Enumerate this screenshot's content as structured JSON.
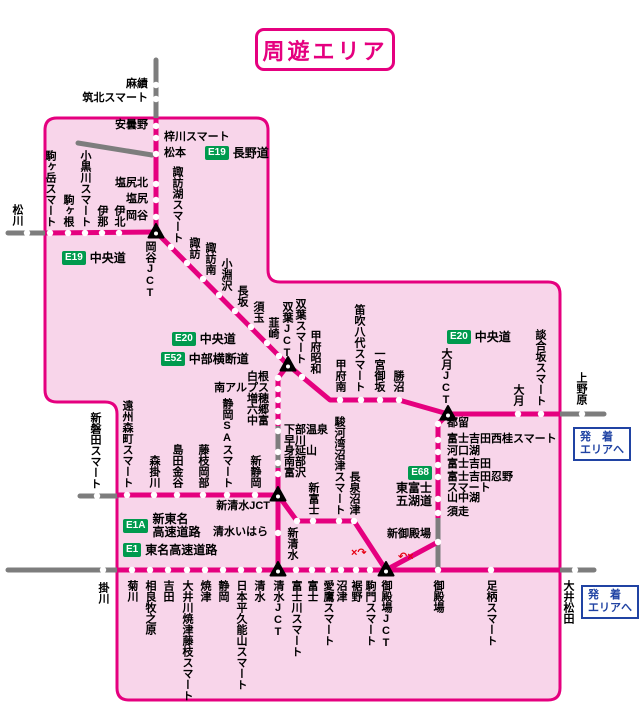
{
  "title": "周遊エリア",
  "colors": {
    "pink": "#e5007f",
    "area_fill": "#f8d5ea",
    "gray": "#7d7d7d",
    "green": "#009a4e",
    "blue": "#2043a3",
    "red": "#e60012"
  },
  "roads": [
    {
      "code": "E19",
      "lines": [
        "長野道"
      ],
      "x": 205,
      "y": 146,
      "dir": "row"
    },
    {
      "code": "E19",
      "lines": [
        "中央道"
      ],
      "x": 62,
      "y": 251,
      "dir": "row"
    },
    {
      "code": "E20",
      "lines": [
        "中央道"
      ],
      "x": 172,
      "y": 332,
      "dir": "row"
    },
    {
      "code": "E52",
      "lines": [
        "中部横断道"
      ],
      "x": 161,
      "y": 352,
      "dir": "row"
    },
    {
      "code": "E20",
      "lines": [
        "中央道"
      ],
      "x": 447,
      "y": 330,
      "dir": "row"
    },
    {
      "code": "E68",
      "lines": [
        "東富士",
        "五湖道"
      ],
      "x": 432,
      "y": 466,
      "dir": "col",
      "align": "right"
    },
    {
      "code": "E1A",
      "lines": [
        "新東名",
        "高速道路"
      ],
      "x": 123,
      "y": 513,
      "dir": "row"
    },
    {
      "code": "E1",
      "lines": [
        "東名高速道路"
      ],
      "x": 123,
      "y": 543,
      "dir": "row"
    }
  ],
  "legend_boxes": [
    {
      "lines": [
        "発　着",
        "エリアへ"
      ],
      "x": 573,
      "y": 427
    },
    {
      "lines": [
        "発　着",
        "エリアへ"
      ],
      "x": 581,
      "y": 585
    }
  ],
  "red_marks": [
    {
      "text": "×↷",
      "x": 351,
      "y": 548
    },
    {
      "text": "↶×",
      "x": 398,
      "y": 552
    }
  ],
  "stations": [
    {
      "t": "麻績",
      "x": 148,
      "y": 85,
      "o": "hl"
    },
    {
      "t": "筑北スマート",
      "x": 148,
      "y": 99,
      "o": "hl"
    },
    {
      "t": "安曇野",
      "x": 148,
      "y": 126,
      "o": "hl"
    },
    {
      "t": "梓川スマート",
      "x": 164,
      "y": 138,
      "o": "hr"
    },
    {
      "t": "松本",
      "x": 164,
      "y": 154,
      "o": "hr"
    },
    {
      "t": "塩尻北",
      "x": 148,
      "y": 184,
      "o": "hl"
    },
    {
      "t": "塩尻",
      "x": 148,
      "y": 200,
      "o": "hl"
    },
    {
      "t": "岡谷",
      "x": 148,
      "y": 217,
      "o": "hl"
    },
    {
      "t": "松川",
      "x": 17,
      "y": 226,
      "o": "vu"
    },
    {
      "t": "駒ヶ岳スマート",
      "x": 50,
      "y": 227,
      "o": "vu"
    },
    {
      "t": "駒ヶ根",
      "x": 68,
      "y": 227,
      "o": "vu"
    },
    {
      "t": "小黒川スマート",
      "x": 85,
      "y": 227,
      "o": "vu"
    },
    {
      "t": "伊那",
      "x": 102,
      "y": 227,
      "o": "vu"
    },
    {
      "t": "伊北",
      "x": 119,
      "y": 227,
      "o": "vu"
    },
    {
      "t": "岡谷JCT",
      "x": 150,
      "y": 241,
      "o": "vd"
    },
    {
      "t": "諏訪湖スマート",
      "x": 177,
      "y": 243,
      "o": "vu"
    },
    {
      "t": "諏訪",
      "x": 194,
      "y": 259,
      "o": "vu"
    },
    {
      "t": "諏訪南",
      "x": 210,
      "y": 275,
      "o": "vu"
    },
    {
      "t": "小淵沢",
      "x": 226,
      "y": 291,
      "o": "vu"
    },
    {
      "t": "長坂",
      "x": 242,
      "y": 307,
      "o": "vu"
    },
    {
      "t": "須玉",
      "x": 258,
      "y": 323,
      "o": "vu"
    },
    {
      "t": "韮崎",
      "x": 273,
      "y": 339,
      "o": "vu"
    },
    {
      "t": "双葉JCT",
      "x": 287,
      "y": 359,
      "o": "vu"
    },
    {
      "t": "双葉スマート",
      "x": 300,
      "y": 364,
      "o": "vu"
    },
    {
      "t": "甲府昭和",
      "x": 315,
      "y": 374,
      "o": "vu"
    },
    {
      "t": "甲府南",
      "x": 340,
      "y": 392,
      "o": "vu"
    },
    {
      "t": "笛吹八代スマート",
      "x": 359,
      "y": 392,
      "o": "vu"
    },
    {
      "t": "一宮御坂",
      "x": 379,
      "y": 392,
      "o": "vu"
    },
    {
      "t": "勝沼",
      "x": 398,
      "y": 392,
      "o": "vu"
    },
    {
      "t": "大月JCT",
      "x": 446,
      "y": 406,
      "o": "vu"
    },
    {
      "t": "大月",
      "x": 518,
      "y": 406,
      "o": "vu"
    },
    {
      "t": "談合坂スマート",
      "x": 540,
      "y": 406,
      "o": "vu"
    },
    {
      "t": "上野原",
      "x": 581,
      "y": 405,
      "o": "vu"
    },
    {
      "t": "都留",
      "x": 447,
      "y": 424,
      "o": "hr"
    },
    {
      "t": "富士吉田西桂スマート",
      "x": 447,
      "y": 440,
      "o": "hr"
    },
    {
      "t": "河口湖",
      "x": 447,
      "y": 452,
      "o": "hr"
    },
    {
      "t": "富士吉田",
      "x": 447,
      "y": 465,
      "o": "hr"
    },
    {
      "t": "富士吉田忍野スマート",
      "lines": [
        "富士吉田忍野",
        "スマート"
      ],
      "x": 447,
      "y": 472,
      "o": "hr"
    },
    {
      "t": "山中湖",
      "x": 447,
      "y": 499,
      "o": "hr"
    },
    {
      "t": "須走",
      "x": 447,
      "y": 513,
      "o": "hr"
    },
    {
      "t": "新御殿場",
      "x": 431,
      "y": 535,
      "o": "hl"
    },
    {
      "t": "白根",
      "x": 269,
      "y": 378,
      "o": "hl"
    },
    {
      "t": "南アルプス",
      "x": 269,
      "y": 389,
      "o": "hl"
    },
    {
      "t": "増穂",
      "x": 269,
      "y": 400,
      "o": "hl"
    },
    {
      "t": "六郷",
      "x": 269,
      "y": 411,
      "o": "hl"
    },
    {
      "t": "中富",
      "x": 269,
      "y": 422,
      "o": "hl"
    },
    {
      "t": "下部温泉早川",
      "lines": [
        "下部温泉",
        "早川"
      ],
      "x": 284,
      "y": 425,
      "o": "hr"
    },
    {
      "t": "身延山",
      "x": 284,
      "y": 452,
      "o": "hr"
    },
    {
      "t": "南部",
      "x": 284,
      "y": 463,
      "o": "hr"
    },
    {
      "t": "富沢",
      "x": 284,
      "y": 474,
      "o": "hr"
    },
    {
      "t": "新磐田スマート",
      "x": 95,
      "y": 489,
      "o": "vu"
    },
    {
      "t": "遠州森町スマート",
      "x": 127,
      "y": 488,
      "o": "vu"
    },
    {
      "t": "森掛川",
      "x": 154,
      "y": 488,
      "o": "vu"
    },
    {
      "t": "島田金谷",
      "x": 177,
      "y": 488,
      "o": "vu"
    },
    {
      "t": "藤枝岡部",
      "x": 203,
      "y": 488,
      "o": "vu"
    },
    {
      "t": "静岡SAスマート",
      "x": 227,
      "y": 488,
      "o": "vu"
    },
    {
      "t": "新静岡",
      "x": 255,
      "y": 488,
      "o": "vu"
    },
    {
      "t": "新清水JCT",
      "x": 270,
      "y": 507,
      "o": "hl"
    },
    {
      "t": "清水いはら",
      "x": 268,
      "y": 533,
      "o": "hl"
    },
    {
      "t": "新清水",
      "x": 292,
      "y": 527,
      "o": "vd"
    },
    {
      "t": "新富士",
      "x": 313,
      "y": 515,
      "o": "vu"
    },
    {
      "t": "駿河湾沼津スマート",
      "x": 339,
      "y": 515,
      "o": "vu"
    },
    {
      "t": "長泉沼津",
      "x": 354,
      "y": 515,
      "o": "vu"
    },
    {
      "t": "掛川",
      "x": 103,
      "y": 582,
      "o": "vd"
    },
    {
      "t": "菊川",
      "x": 132,
      "y": 580,
      "o": "vd"
    },
    {
      "t": "相良牧之原",
      "x": 150,
      "y": 580,
      "o": "vd"
    },
    {
      "t": "吉田",
      "x": 168,
      "y": 580,
      "o": "vd"
    },
    {
      "t": "大井川焼津藤枝スマート",
      "x": 187,
      "y": 580,
      "o": "vd"
    },
    {
      "t": "焼津",
      "x": 205,
      "y": 580,
      "o": "vd"
    },
    {
      "t": "静岡",
      "x": 223,
      "y": 580,
      "o": "vd"
    },
    {
      "t": "日本平久能山スマート",
      "x": 241,
      "y": 580,
      "o": "vd"
    },
    {
      "t": "清水",
      "x": 259,
      "y": 580,
      "o": "vd"
    },
    {
      "t": "清水JCT",
      "x": 278,
      "y": 580,
      "o": "vd"
    },
    {
      "t": "富士川スマート",
      "x": 296,
      "y": 580,
      "o": "vd"
    },
    {
      "t": "富士",
      "x": 312,
      "y": 580,
      "o": "vd"
    },
    {
      "t": "愛鷹スマート",
      "x": 328,
      "y": 580,
      "o": "vd"
    },
    {
      "t": "沼津",
      "x": 341,
      "y": 580,
      "o": "vd"
    },
    {
      "t": "裾野",
      "x": 356,
      "y": 580,
      "o": "vd"
    },
    {
      "t": "駒門スマート",
      "x": 370,
      "y": 580,
      "o": "vd"
    },
    {
      "t": "御殿場JCT",
      "x": 386,
      "y": 580,
      "o": "vd"
    },
    {
      "t": "御殿場",
      "x": 438,
      "y": 580,
      "o": "vd"
    },
    {
      "t": "足柄スマート",
      "x": 491,
      "y": 580,
      "o": "vd"
    },
    {
      "t": "大井松田",
      "x": 568,
      "y": 580,
      "o": "vd"
    }
  ],
  "geometry": {
    "area_path": "M 57 118 L 256 118 Q 268 118 268 130 L 268 270 Q 268 282 280 282 L 548 282 Q 560 282 560 294 L 560 688 Q 560 700 548 700 L 129 700 Q 117 700 117 688 L 117 414 Q 117 402 105 402 L 57 402 Q 45 402 45 390 L 45 130 Q 45 118 57 118 Z",
    "gray_lines": [
      [
        [
          156,
          60
        ],
        [
          156,
          118
        ]
      ],
      [
        [
          78,
          143
        ],
        [
          152,
          155
        ]
      ],
      [
        [
          8,
          233
        ],
        [
          45,
          233
        ]
      ],
      [
        [
          560,
          414
        ],
        [
          604,
          414
        ]
      ],
      [
        [
          278,
          426
        ],
        [
          278,
          468
        ]
      ],
      [
        [
          438,
          518
        ],
        [
          438,
          570
        ]
      ],
      [
        [
          80,
          496
        ],
        [
          117,
          496
        ]
      ],
      [
        [
          8,
          570
        ],
        [
          117,
          570
        ]
      ],
      [
        [
          560,
          570
        ],
        [
          594,
          570
        ]
      ]
    ],
    "pink_lines": [
      [
        [
          156,
          118
        ],
        [
          156,
          232
        ]
      ],
      [
        [
          45,
          233
        ],
        [
          156,
          232
        ]
      ],
      [
        [
          156,
          232
        ],
        [
          288,
          365
        ]
      ],
      [
        [
          288,
          365
        ],
        [
          330,
          400
        ],
        [
          399,
          400
        ],
        [
          448,
          414
        ],
        [
          560,
          414
        ]
      ],
      [
        [
          288,
          365
        ],
        [
          278,
          378
        ],
        [
          278,
          426
        ]
      ],
      [
        [
          278,
          468
        ],
        [
          278,
          495
        ]
      ],
      [
        [
          117,
          495
        ],
        [
          278,
          495
        ]
      ],
      [
        [
          278,
          495
        ],
        [
          278,
          570
        ]
      ],
      [
        [
          278,
          495
        ],
        [
          297,
          521
        ],
        [
          354,
          521
        ],
        [
          386,
          570
        ]
      ],
      [
        [
          117,
          570
        ],
        [
          560,
          570
        ]
      ],
      [
        [
          448,
          414
        ],
        [
          438,
          424
        ],
        [
          438,
          518
        ]
      ],
      [
        [
          386,
          570
        ],
        [
          438,
          542
        ]
      ]
    ],
    "dots": [
      [
        156,
        85
      ],
      [
        156,
        99
      ],
      [
        156,
        126
      ],
      [
        156,
        138
      ],
      [
        156,
        154
      ],
      [
        156,
        184
      ],
      [
        156,
        200
      ],
      [
        156,
        217
      ],
      [
        27,
        233
      ],
      [
        50,
        233
      ],
      [
        68,
        233
      ],
      [
        85,
        233
      ],
      [
        102,
        233
      ],
      [
        119,
        233
      ],
      [
        171,
        247
      ],
      [
        187,
        263
      ],
      [
        203,
        279
      ],
      [
        219,
        295
      ],
      [
        235,
        311
      ],
      [
        251,
        327
      ],
      [
        267,
        343
      ],
      [
        279,
        356
      ],
      [
        302,
        377
      ],
      [
        340,
        400
      ],
      [
        361,
        400
      ],
      [
        380,
        400
      ],
      [
        399,
        400
      ],
      [
        518,
        414
      ],
      [
        541,
        414
      ],
      [
        582,
        414
      ],
      [
        438,
        424
      ],
      [
        438,
        440
      ],
      [
        438,
        452
      ],
      [
        438,
        465
      ],
      [
        438,
        477
      ],
      [
        438,
        499
      ],
      [
        438,
        513
      ],
      [
        438,
        542
      ],
      [
        278,
        378
      ],
      [
        278,
        389
      ],
      [
        278,
        400
      ],
      [
        278,
        411
      ],
      [
        278,
        422
      ],
      [
        278,
        431
      ],
      [
        278,
        452
      ],
      [
        278,
        463
      ],
      [
        278,
        474
      ],
      [
        97,
        496
      ],
      [
        127,
        495
      ],
      [
        154,
        495
      ],
      [
        177,
        495
      ],
      [
        203,
        495
      ],
      [
        227,
        495
      ],
      [
        255,
        495
      ],
      [
        278,
        533
      ],
      [
        297,
        521
      ],
      [
        313,
        521
      ],
      [
        339,
        521
      ],
      [
        354,
        521
      ],
      [
        103,
        570
      ],
      [
        132,
        570
      ],
      [
        150,
        570
      ],
      [
        168,
        570
      ],
      [
        187,
        570
      ],
      [
        205,
        570
      ],
      [
        223,
        570
      ],
      [
        241,
        570
      ],
      [
        259,
        570
      ],
      [
        296,
        570
      ],
      [
        312,
        570
      ],
      [
        328,
        570
      ],
      [
        341,
        570
      ],
      [
        356,
        570
      ],
      [
        370,
        570
      ],
      [
        438,
        570
      ],
      [
        491,
        570
      ],
      [
        575,
        570
      ]
    ],
    "jcts": [
      [
        156,
        232
      ],
      [
        288,
        365
      ],
      [
        448,
        414
      ],
      [
        278,
        495
      ],
      [
        278,
        570
      ],
      [
        386,
        570
      ]
    ]
  }
}
